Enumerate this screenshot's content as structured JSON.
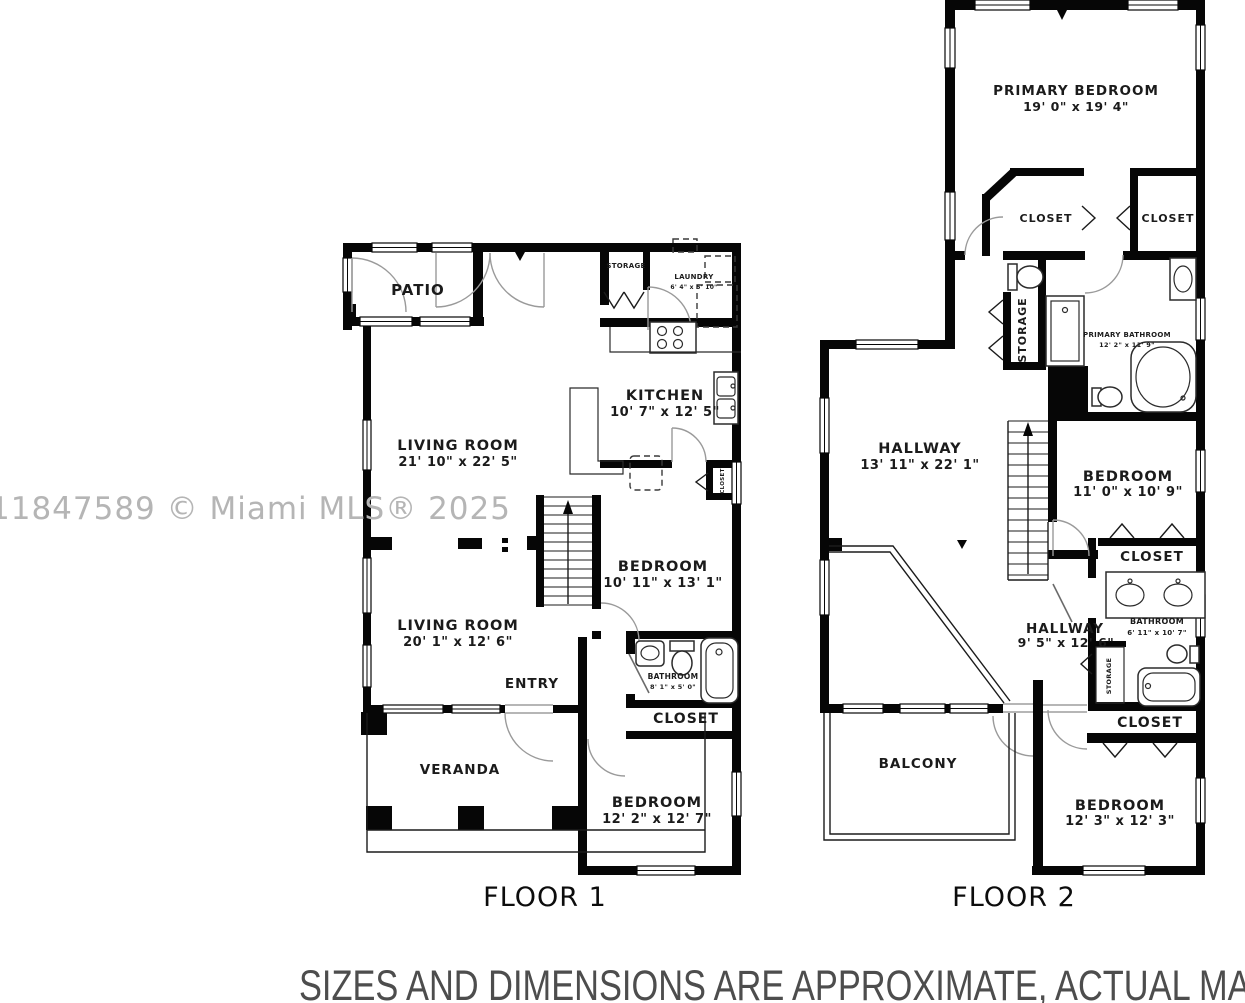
{
  "watermark": "11847589 © Miami MLS® 2025",
  "disclaimer": "SIZES AND DIMENSIONS ARE APPROXIMATE, ACTUAL MAY VARY",
  "colors": {
    "wall": "#060606",
    "watermark": "#b5b5b5",
    "disclaimer": "#4d4d4d"
  },
  "floor1": {
    "title": "FLOOR 1",
    "patio": "PATIO",
    "storage": "STORAGE",
    "laundry": {
      "name": "LAUNDRY",
      "dims": "6' 4\" x 5' 10\""
    },
    "kitchen": {
      "name": "KITCHEN",
      "dims": "10' 7\" x 12' 5\""
    },
    "living_room_upper": {
      "name": "LIVING ROOM",
      "dims": "21' 10\" x 22' 5\""
    },
    "living_room_lower": {
      "name": "LIVING ROOM",
      "dims": "20' 1\" x 12' 6\""
    },
    "bedroom_mid": {
      "name": "BEDROOM",
      "dims": "10' 11\" x 13' 1\""
    },
    "closet_kitchen": "CLOSET",
    "bathroom": {
      "name": "BATHROOM",
      "dims": "8' 1\" x 5' 0\""
    },
    "entry": "ENTRY",
    "closet": "CLOSET",
    "veranda": "VERANDA",
    "bedroom_bottom": {
      "name": "BEDROOM",
      "dims": "12' 2\" x 12' 7\""
    }
  },
  "floor2": {
    "title": "FLOOR 2",
    "primary_bedroom": {
      "name": "PRIMARY BEDROOM",
      "dims": "19' 0\" x 19' 4\""
    },
    "closet_left": "CLOSET",
    "closet_right": "CLOSET",
    "storage_bath": "STORAGE",
    "primary_bathroom": {
      "name": "PRIMARY BATHROOM",
      "dims": "12' 2\" x 11' 9\""
    },
    "hallway_main": {
      "name": "HALLWAY",
      "dims": "13' 11\" x 22' 1\""
    },
    "bedroom_mid": {
      "name": "BEDROOM",
      "dims": "11' 0\" x 10' 9\""
    },
    "closet_mid": "CLOSET",
    "bathroom": {
      "name": "BATHROOM",
      "dims": "6' 11\" x 10' 7\""
    },
    "hallway_small": {
      "name": "HALLWAY",
      "dims": "9' 5\" x 12' 6\""
    },
    "storage_small": "STORAGE",
    "closet_bottom": "CLOSET",
    "balcony": "BALCONY",
    "bedroom_bottom": {
      "name": "BEDROOM",
      "dims": "12' 3\" x 12' 3\""
    }
  }
}
